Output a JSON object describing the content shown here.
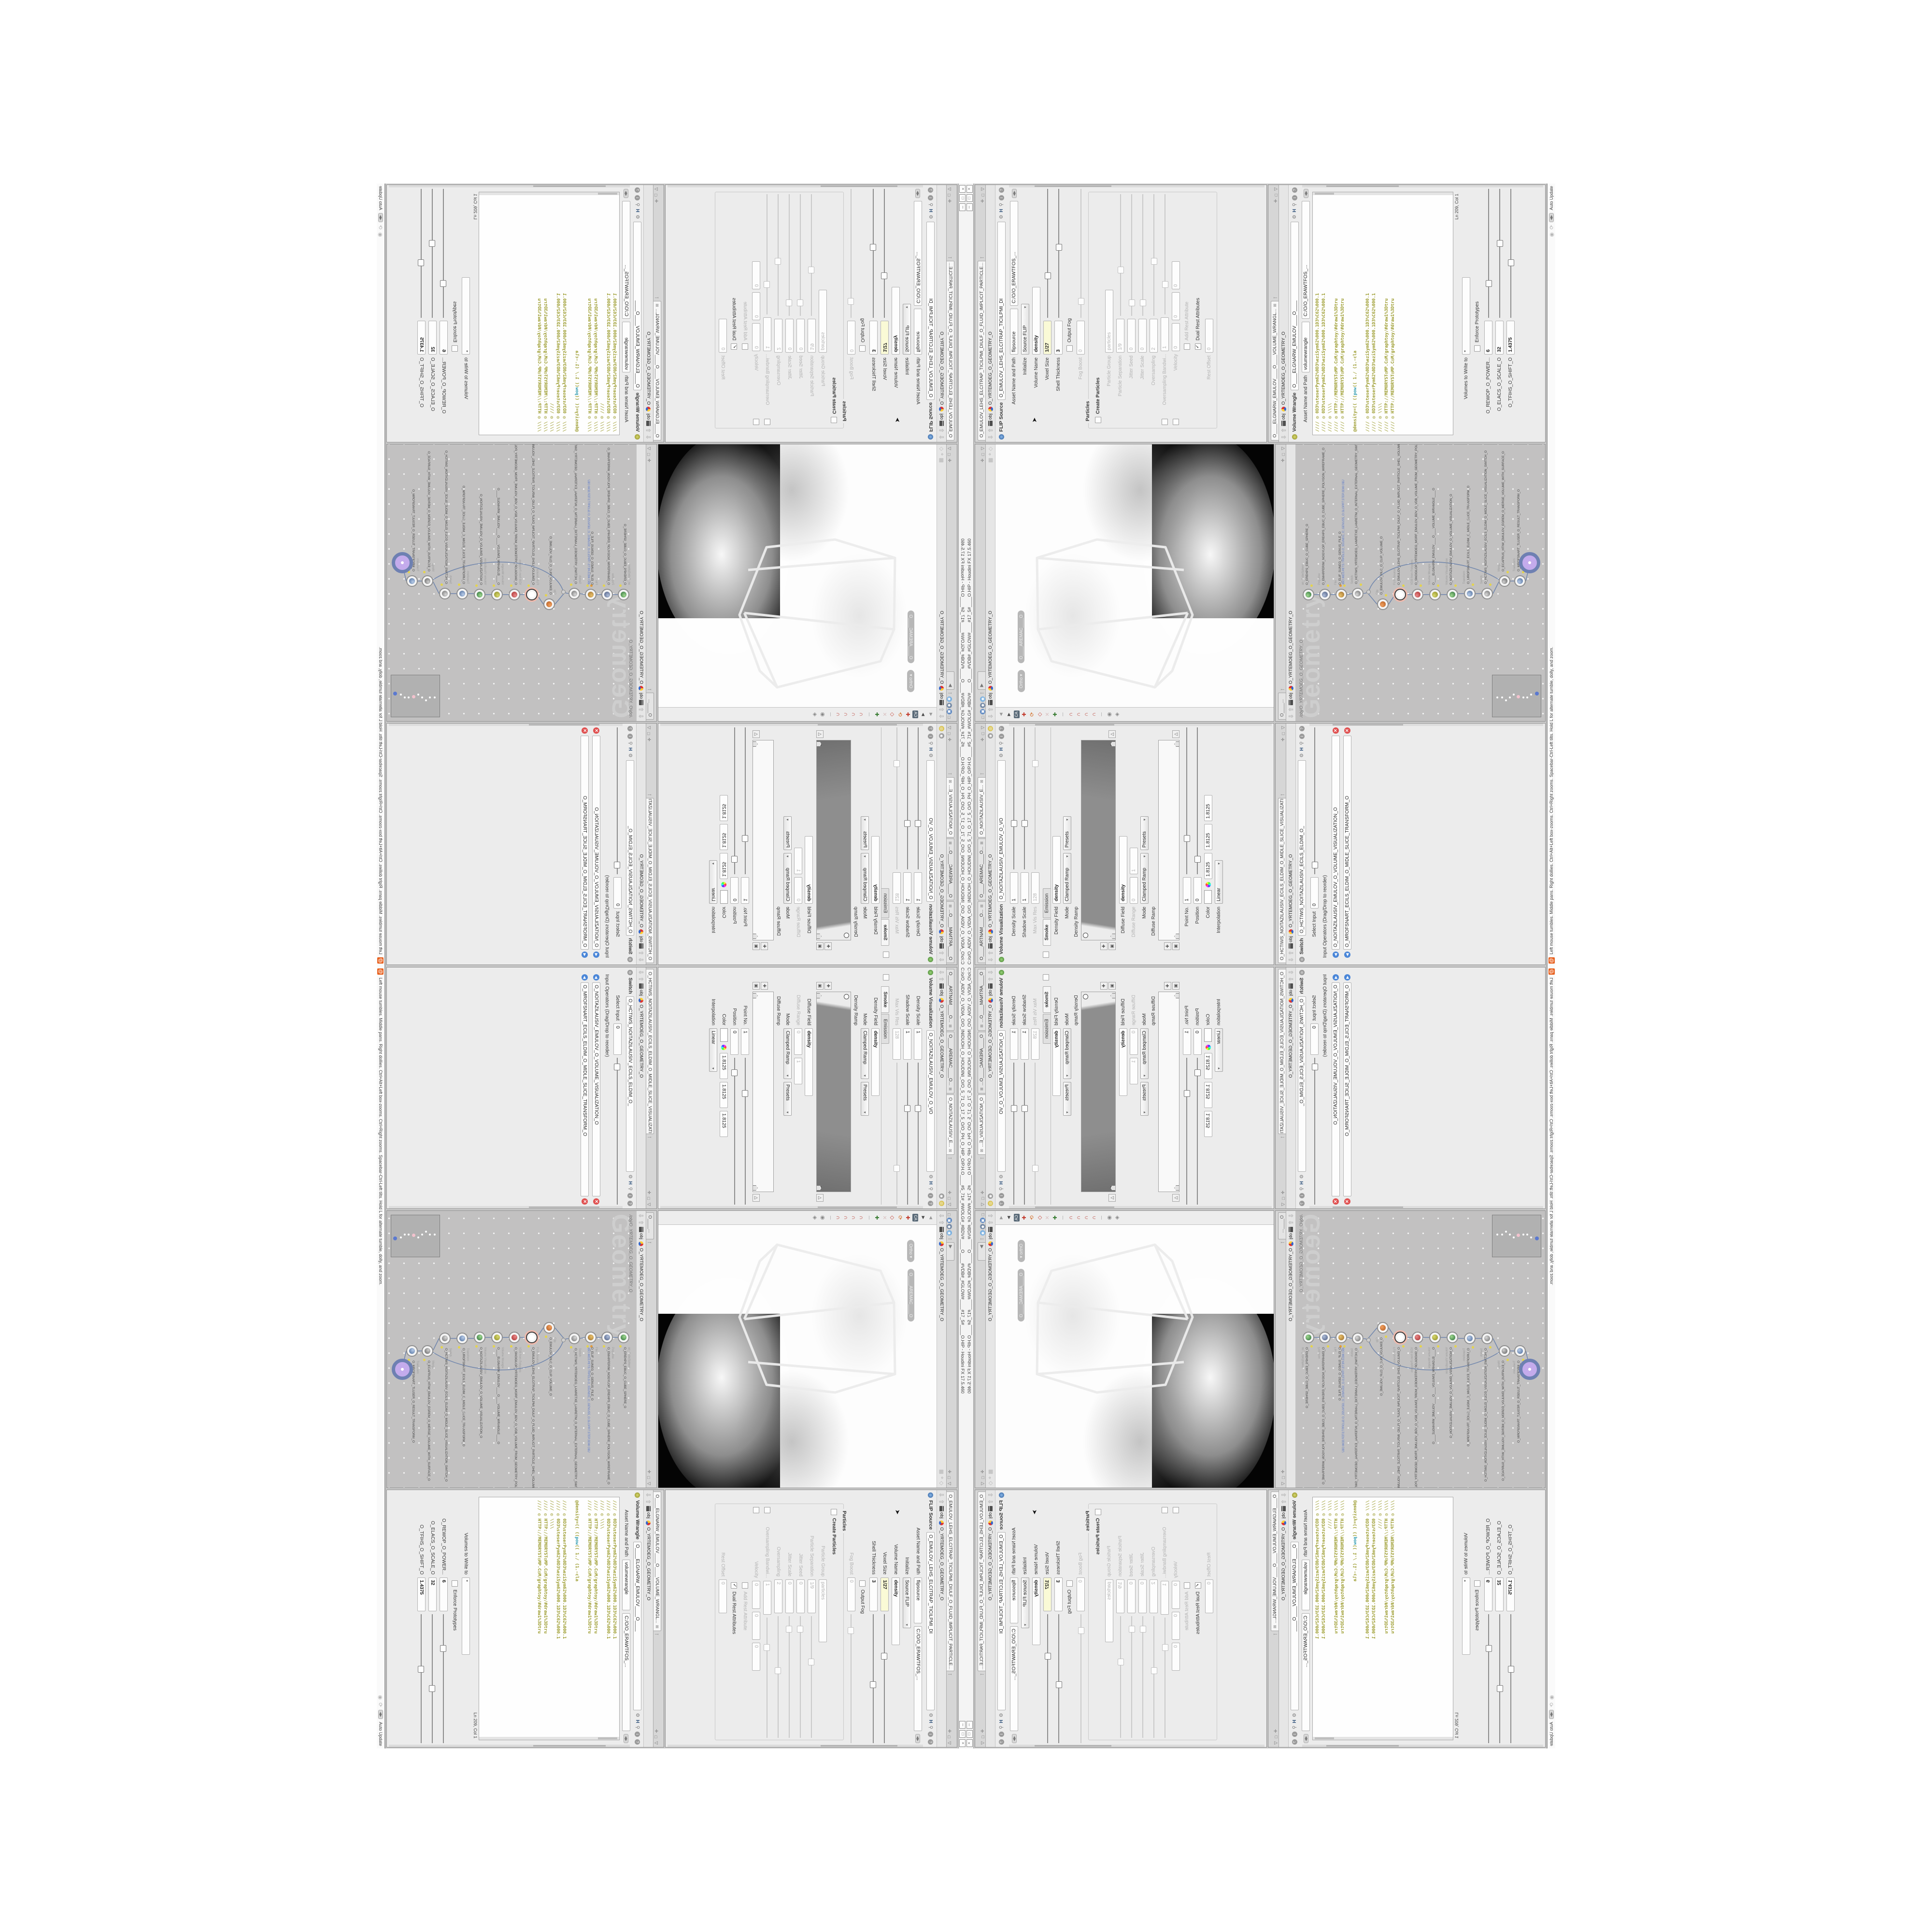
{
  "window": {
    "title": "C:/o/O_AIDIV_O_VIDIA_O/O_INIDUOH_O_HOUDINI_O/O_5_71_O_17_5_O/O_PH_O_HIP_O/P.H.O____#5_71#_#WOLG#_#BDV#____O____#VDB#_#GLOW#____#17_5#____O.HIP - Houdini FX 17.5.460",
    "btn_min": "─",
    "btn_restore": "□",
    "btn_close": "×"
  },
  "statusbar": {
    "hint": "Left mouse tumbles. Middle pans. Right dollies. Ctrl+Alt+Left box-zooms. Ctrl+Right zooms. Spacebar-Ctrl-Left tilts. Hold L for alternate tumble, dolly, and zoom.",
    "update_mode": "Auto Update"
  },
  "crumb": {
    "root": "obj",
    "node": "O_YRTEMOEG_O_GEOMETRY_O"
  },
  "viewport": {
    "pill_view": "Ortho ▾",
    "pill_camera": "O____AREMAC____O"
  },
  "network": {
    "tab": "O____...",
    "watermark": "Geometry",
    "path": "/obj/O_YRTEMOEG_O_GEOMETRY_O",
    "nodes": [
      {
        "type": "an_CubeSphere",
        "name": "O_EREHPS_EBUC_O_CUBE_SPHERE_O"
      },
      {
        "type": "PolyWire",
        "name": "O_EMARFERIW_NOGYLOP_EREHPS_EBUC_O_CUBE_SPHERE_POLYGON_WIREFRAME_O"
      },
      {
        "type": "File",
        "name": "O_ELIF_SUNEG_O_GENUS_FILE_O",
        "sub": "JBO.WD3.PETS.TRPOLS.O_5SUNEG_O_GENUS5_O.SLOPRT.STEP.3DW.OBJ"
      },
      {
        "type": "Switch",
        "name": "O_HCTIWS_YRTEMOEG_LANRETXE_LANRETNI_O_INTERNAL_EXTERNAL_GEOMETRY_SWITCH_O"
      },
      {
        "type": "Clip",
        "name": "O_EMULOV_PILC_O_CLIP_VOLUME_O"
      },
      {
        "type": "FLIP Source",
        "name": "O_EMULOV_LEHS_ELCITRAP_TICILPMI_DIULF_O_FLUID_IMPLICIT_PARTICLE_SHEL_VOLUME_O"
      },
      {
        "type": "VDB from Polygons",
        "name": "O_SNOGILOP_YRTEMOEG_MORF_EMULOV_BDV_O_VDB_VOLUME_FROM_GEOMETRY_POLYGONS_O"
      },
      {
        "type": "Volume Wrangle",
        "name": "O____ELGNARW_EMULOV____O____VOLUME_WRANGLE____O"
      },
      {
        "type": "Volume Visualization",
        "name": "O_NOITAZILAUSIV_EMULOV_O_VOLUME_VISUALIZATION_O"
      },
      {
        "type": "Transform",
        "name": "O_MROFSNART_ECILS_ELDIM_O_MIDLE_SLICE_TRANSFORM_O"
      },
      {
        "type": "Switch",
        "name": "O_HCTIWS_NOITAZILAUSIV_ECILS_ELDIM_O_MIDLE_SLICE_VISUALIZATION_SWITCH_O"
      },
      {
        "type": "Merge",
        "name": "O_ECAFRUS_HTIW_EMULOV_EGREM_O_MERGE_VOLUME_WITH_SURFACE_O"
      },
      {
        "type": "Transform",
        "name": "O_MROFSNART_TLUSER_O_RESULT_TRANSFORM_O"
      }
    ]
  },
  "volvis": {
    "tab1": "O____ARTNAM____O...",
    "tab2": "O____AREMAC____O...",
    "tab3": "O_NOITAZILAUSIV_E...",
    "type": "Volume Visualization",
    "name": "O_NOITAZILAUSIV_EMULOV_O_VO",
    "density_scale_label": "Density Scale",
    "density_scale": "1",
    "shadow_scale_label": "Shadow Scale",
    "shadow_scale": "1",
    "maxvis_label": "Max Vis Res",
    "maxvis": "128",
    "folder_smoke": "Smoke",
    "folder_emission": "Emission",
    "density_field_label": "Density Field",
    "density_field": "density",
    "mode_label": "Mode",
    "mode": "Clamped Ramp",
    "presets": "Presets",
    "density_ramp_label": "Density Ramp",
    "diffuse_field_label": "Diffuse Field",
    "diffuse_field": "density",
    "diffuse_range_label": "Diffuse Range",
    "diffuse_min": "0",
    "diffuse_max": "1",
    "mode2": "Clamped Ramp",
    "presets2": "Presets",
    "diffuse_ramp_label": "Diffuse Ramp",
    "point_label": "Point No.",
    "point": "1",
    "position_label": "Position",
    "position": "0",
    "color_label": "Color",
    "color_r": "1.8125",
    "color_g": "1.8125",
    "color_b": "1.8125",
    "interp_label": "Interpolation",
    "interp": "Linear"
  },
  "switchp": {
    "tab": "O_HCTIWS_NOITAZILAUSIV_ECILS_ELDIM_O_MIDLE_SLICE_VISUALIZATION...",
    "type": "Switch",
    "name": "O_HCTIWS_NOITAZILAUSIV_ECILS_ELDIM_O_",
    "select_label": "Select Input",
    "select": "0",
    "ops_label": "Input Operators (Drag/Drop to reorder)",
    "op1": "O_NOITAZILAUSIV_EMULOV_O_VOLUME_VISUALIZATION_O",
    "op2": "O_MROFSNART_ECILS_ELDIM_O_MIDLE_SLICE_TRANSFORM_O"
  },
  "flip": {
    "tab": "O_EMULOV_LEHS_ELCITRAP_TICILPMI_DIULF_O_FLUID_IMPLICIT_PARTICLE...",
    "type": "FLIP Source",
    "name": "O_EMULOV_LEHS_ELCITRAP_TICILPMI_DI",
    "asset_label": "Asset Name and Path",
    "asset_name": "flipsource",
    "asset_path": "C:/O/O_ERAWTFOS_...",
    "initialize_label": "Initialize",
    "initialize": "Source FLIP",
    "volume_name_label": "Volume Name",
    "volume_name": "density",
    "voxel_label": "Voxel Size",
    "voxel": "1/27",
    "shell_label": "Shell Thickness",
    "shell": "3",
    "output_fog": "Output Fog",
    "fog_boost_label": "Fog Boost",
    "fog_boost": "0",
    "particles_group": "Particles",
    "create_particles": "Create Particles",
    "pgroup_label": "Particle Group",
    "pgroup": "particles",
    "psep_label": "Particle Separation",
    "psep": "1/9",
    "jseed_label": "Jitter Seed",
    "jseed": "0",
    "jscale_label": "Jitter Scale",
    "jscale": "0",
    "over_label": "Oversampling",
    "over": "2",
    "overbw_label": "Oversampling Bandwi...",
    "overbw": "1",
    "vel_label": "Velocity",
    "vel_x": "0",
    "vel_y": "0",
    "vel_z": "0",
    "addrest": "Add Rest Attribute",
    "dualrest": "Dual Rest Attributes",
    "check": "✓",
    "restoff_label": "Rest Offset",
    "restoff": "0"
  },
  "wrangle": {
    "tab": "O____ELGNARW_EMULOV____O____VOLUME_WRANGL...",
    "type": "Volume Wrangle",
    "name": "O____ELGNARW_EMULOV____O____",
    "asset_label": "Asset Name and Path",
    "asset_name": "volumewrangle",
    "asset_path": "C:/O/O_ERAWTFOS_...",
    "code_top_0": "//// ◎ 0D3%steserPym62%0D3%eziSym62%000.1D3%C62%000.1",
    "code_top_1": "//// ◎ 0D3%steserPym62%0D3%eziSym62%000.1D3%C62%000.1",
    "code_top_2": "//// ◎ \\\\\\\\",
    "code_top_3": "//// ◎ HTTP://MEMORYST◎MP.C◎M/graphtoy/#draw1%3Dtru",
    "code_top_4": "//// ◎ HTTP://MEMORYST◎MP.C◎M/graphtoy/#draw1%3Dtru",
    "code_mid_a": "@density=((     ((",
    "code_mid_kw": "pow",
    "code_mid_b": "((     1./ (1.-cla",
    "code_bot_0": "//// ◎ 0D3%steserPym62%0D3%eziSym62%000.1D3%C62%000.1",
    "code_bot_1": "//// ◎ 0D3%steserPym62%0D3%eziSym62%000.1D3%C62%000.1",
    "code_bot_2": "//// ◎ \\\\\\\\",
    "code_bot_3": "//// ◎ HTTP://MEMORYST◎MP.C◎M/graphtoy/#draw1%3Dtru",
    "code_bot_4": "//// ◎ HTTP://MEMORYST◎MP.C◎M/graphtoy/#draw1%3Dtru",
    "cursor_pos": "Ln 209, Col 1",
    "volumes_label": "Volumes to Write to",
    "volumes": "*",
    "enforce": "Enforce Prototypes",
    "power_label": "O_REWOP_O_POWER...",
    "power": "6",
    "scale_label": "O_ELACS_O_SCALE_O",
    "scale": "32",
    "shift_label": "O_TFIHS_O_SHIFT_O",
    "shift": "1.4375"
  }
}
